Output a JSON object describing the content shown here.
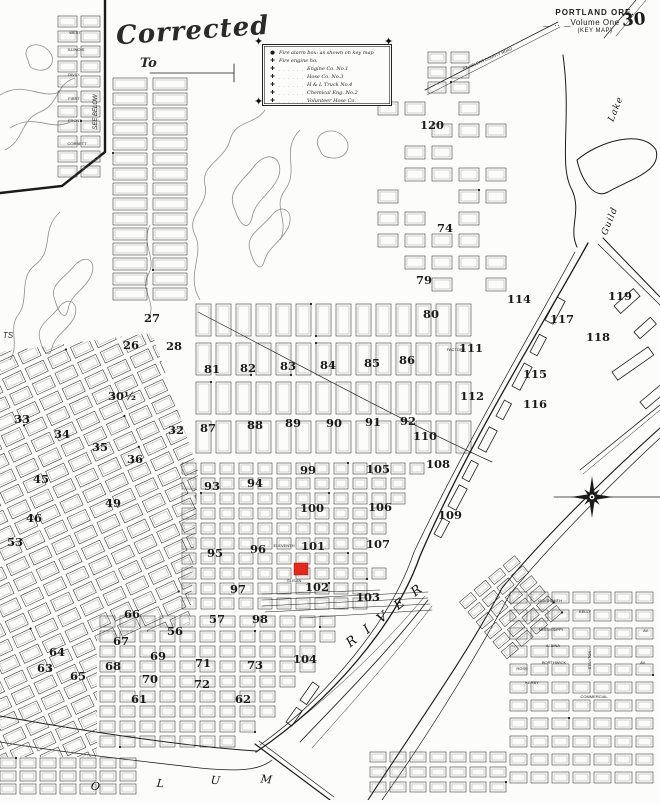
{
  "page": {
    "title": "PORTLAND ORE.",
    "subtitle": "Volume One",
    "map_type": "(KEY MAP)",
    "page_number": "30",
    "decor_dashes": "— ·· —",
    "corner_note": "also  shown"
  },
  "corrected": {
    "word": "Corrected",
    "to": "To"
  },
  "legend": {
    "alarm_symbol": "●",
    "engine_symbol": "✚",
    "corner_ornament": "✦",
    "alarm_line": "Fire alarm box: as shown on key map",
    "engine_line": "Fire engine ho.",
    "leader": ". . . . . .",
    "items": [
      "Engine Co. No.1",
      "Hose Co. No.3",
      "H & L Truck No.4",
      "Chemical Eng. No.2",
      "Volunteer Hose Co."
    ]
  },
  "colors": {
    "ink": "#1b1b1b",
    "contour": "#8f8f8f",
    "block": "#2e2e2e",
    "inner": "#9a9a9a",
    "marker": "#e5271d"
  },
  "marker": {
    "x": 294,
    "y": 563,
    "w": 14,
    "h": 12
  },
  "compass": {
    "x": 592,
    "y": 497
  },
  "water_labels": [
    {
      "text": "R I V E R",
      "x": 388,
      "y": 618,
      "r": -38,
      "s": 13,
      "i": true,
      "sp": 4
    },
    {
      "text": "Guild",
      "x": 612,
      "y": 222,
      "r": -68,
      "s": 9,
      "i": true,
      "sp": 1
    },
    {
      "text": "Lake",
      "x": 618,
      "y": 110,
      "r": -68,
      "s": 9,
      "i": true,
      "sp": 1
    },
    {
      "text": "O",
      "x": 95,
      "y": 790,
      "r": 6,
      "s": 11,
      "i": true,
      "sp": 0
    },
    {
      "text": "L",
      "x": 160,
      "y": 787,
      "r": 6,
      "s": 11,
      "i": true,
      "sp": 0
    },
    {
      "text": "U",
      "x": 215,
      "y": 784,
      "r": 6,
      "s": 11,
      "i": true,
      "sp": 0
    },
    {
      "text": "M",
      "x": 266,
      "y": 783,
      "r": 6,
      "s": 11,
      "i": true,
      "sp": 0
    }
  ],
  "street_labels": [
    {
      "text": "WEST",
      "x": 75,
      "y": 34,
      "s": 4
    },
    {
      "text": "ILLINOIS",
      "x": 76,
      "y": 51,
      "s": 4
    },
    {
      "text": "DIVID.",
      "x": 74,
      "y": 76,
      "s": 4
    },
    {
      "text": "FIRST",
      "x": 74,
      "y": 100,
      "s": 4
    },
    {
      "text": "FRONT",
      "x": 75,
      "y": 122,
      "s": 4
    },
    {
      "text": "CORBETT",
      "x": 77,
      "y": 145,
      "s": 4
    },
    {
      "text": "SEE BELOW",
      "x": 97,
      "y": 112,
      "s": 6,
      "r": -90,
      "i": true
    },
    {
      "text": "ST. HELENS COUNTY ROAD",
      "x": 488,
      "y": 60,
      "s": 4,
      "r": -23
    },
    {
      "text": "ELEVENTH",
      "x": 284,
      "y": 547,
      "s": 4
    },
    {
      "text": "GLISAN",
      "x": 294,
      "y": 582,
      "s": 4
    },
    {
      "text": "FACTORY",
      "x": 456,
      "y": 351,
      "s": 4
    },
    {
      "text": "GOLDSMITH",
      "x": 550,
      "y": 602,
      "s": 4
    },
    {
      "text": "KELLY",
      "x": 585,
      "y": 613,
      "s": 4
    },
    {
      "text": "MISSISSIPPI",
      "x": 551,
      "y": 631,
      "s": 4
    },
    {
      "text": "ALBINA",
      "x": 553,
      "y": 647,
      "s": 4
    },
    {
      "text": "BORTHWICK",
      "x": 554,
      "y": 664,
      "s": 4
    },
    {
      "text": "ROSS",
      "x": 522,
      "y": 670,
      "s": 4
    },
    {
      "text": "KERBY",
      "x": 532,
      "y": 684,
      "s": 4
    },
    {
      "text": "COMMERCIAL",
      "x": 594,
      "y": 698,
      "s": 4
    },
    {
      "text": "STANTON",
      "x": 591,
      "y": 660,
      "s": 4,
      "r": -90
    },
    {
      "text": "AV.",
      "x": 646,
      "y": 632,
      "s": 4
    },
    {
      "text": "AV.",
      "x": 643,
      "y": 664,
      "s": 4
    },
    {
      "text": "TS",
      "x": 8,
      "y": 338,
      "s": 8,
      "i": true
    }
  ],
  "district_numbers": [
    {
      "n": "120",
      "x": 432,
      "y": 129
    },
    {
      "n": "74",
      "x": 445,
      "y": 232
    },
    {
      "n": "79",
      "x": 424,
      "y": 284
    },
    {
      "n": "80",
      "x": 431,
      "y": 318
    },
    {
      "n": "86",
      "x": 407,
      "y": 364
    },
    {
      "n": "114",
      "x": 519,
      "y": 303
    },
    {
      "n": "119",
      "x": 620,
      "y": 300
    },
    {
      "n": "117",
      "x": 562,
      "y": 323
    },
    {
      "n": "118",
      "x": 598,
      "y": 341
    },
    {
      "n": "111",
      "x": 471,
      "y": 352
    },
    {
      "n": "112",
      "x": 472,
      "y": 400
    },
    {
      "n": "115",
      "x": 535,
      "y": 378
    },
    {
      "n": "116",
      "x": 535,
      "y": 408
    },
    {
      "n": "81",
      "x": 212,
      "y": 373
    },
    {
      "n": "82",
      "x": 248,
      "y": 372
    },
    {
      "n": "83",
      "x": 288,
      "y": 370
    },
    {
      "n": "84",
      "x": 328,
      "y": 369
    },
    {
      "n": "85",
      "x": 372,
      "y": 367
    },
    {
      "n": "87",
      "x": 208,
      "y": 432
    },
    {
      "n": "88",
      "x": 255,
      "y": 429
    },
    {
      "n": "89",
      "x": 293,
      "y": 427
    },
    {
      "n": "90",
      "x": 334,
      "y": 427
    },
    {
      "n": "91",
      "x": 373,
      "y": 426
    },
    {
      "n": "92",
      "x": 408,
      "y": 425
    },
    {
      "n": "93",
      "x": 212,
      "y": 490
    },
    {
      "n": "94",
      "x": 255,
      "y": 487
    },
    {
      "n": "99",
      "x": 308,
      "y": 474
    },
    {
      "n": "105",
      "x": 378,
      "y": 473
    },
    {
      "n": "100",
      "x": 312,
      "y": 512
    },
    {
      "n": "106",
      "x": 380,
      "y": 511
    },
    {
      "n": "95",
      "x": 215,
      "y": 557
    },
    {
      "n": "96",
      "x": 258,
      "y": 553
    },
    {
      "n": "101",
      "x": 313,
      "y": 550
    },
    {
      "n": "107",
      "x": 378,
      "y": 548
    },
    {
      "n": "102",
      "x": 317,
      "y": 591
    },
    {
      "n": "103",
      "x": 368,
      "y": 601
    },
    {
      "n": "104",
      "x": 305,
      "y": 663
    },
    {
      "n": "108",
      "x": 438,
      "y": 468
    },
    {
      "n": "109",
      "x": 450,
      "y": 519
    },
    {
      "n": "110",
      "x": 425,
      "y": 440
    },
    {
      "n": "26",
      "x": 131,
      "y": 349
    },
    {
      "n": "27",
      "x": 152,
      "y": 322
    },
    {
      "n": "28",
      "x": 174,
      "y": 350
    },
    {
      "n": "30½",
      "x": 122,
      "y": 400
    },
    {
      "n": "32",
      "x": 176,
      "y": 434
    },
    {
      "n": "33",
      "x": 22,
      "y": 423
    },
    {
      "n": "34",
      "x": 62,
      "y": 438
    },
    {
      "n": "35",
      "x": 100,
      "y": 451
    },
    {
      "n": "36",
      "x": 135,
      "y": 463
    },
    {
      "n": "45",
      "x": 41,
      "y": 483
    },
    {
      "n": "46",
      "x": 34,
      "y": 522
    },
    {
      "n": "49",
      "x": 113,
      "y": 507
    },
    {
      "n": "53",
      "x": 15,
      "y": 546
    },
    {
      "n": "56",
      "x": 175,
      "y": 635
    },
    {
      "n": "57",
      "x": 217,
      "y": 623
    },
    {
      "n": "98",
      "x": 260,
      "y": 623
    },
    {
      "n": "97",
      "x": 238,
      "y": 593
    },
    {
      "n": "66",
      "x": 132,
      "y": 618
    },
    {
      "n": "67",
      "x": 121,
      "y": 645
    },
    {
      "n": "68",
      "x": 113,
      "y": 670
    },
    {
      "n": "69",
      "x": 158,
      "y": 660
    },
    {
      "n": "70",
      "x": 150,
      "y": 683
    },
    {
      "n": "71",
      "x": 203,
      "y": 667
    },
    {
      "n": "72",
      "x": 202,
      "y": 688
    },
    {
      "n": "73",
      "x": 255,
      "y": 669
    },
    {
      "n": "61",
      "x": 139,
      "y": 703
    },
    {
      "n": "62",
      "x": 243,
      "y": 703
    },
    {
      "n": "63",
      "x": 45,
      "y": 672
    },
    {
      "n": "64",
      "x": 57,
      "y": 656
    },
    {
      "n": "65",
      "x": 78,
      "y": 680
    }
  ],
  "regions": [
    {
      "name": "left-strips",
      "x0": 113,
      "y0": 78,
      "cols": 2,
      "rows": 15,
      "bw": 34,
      "bh": 12,
      "sx": 40,
      "sy": 15
    },
    {
      "name": "inset-grid",
      "x0": 58,
      "y0": 16,
      "cols": 2,
      "rows": 11,
      "bw": 19,
      "bh": 11,
      "sx": 23,
      "sy": 15
    },
    {
      "name": "north-sparse",
      "x0": 378,
      "y0": 102,
      "cols": 5,
      "rows": 9,
      "bw": 20,
      "bh": 13,
      "sx": 27,
      "sy": 22,
      "skip": 0.38
    },
    {
      "name": "north-cluster",
      "x0": 428,
      "y0": 52,
      "cols": 2,
      "rows": 3,
      "bw": 18,
      "bh": 11,
      "sx": 23,
      "sy": 15
    },
    {
      "name": "nw-tall-grid",
      "x0": 196,
      "y0": 304,
      "cols": 14,
      "rows": 4,
      "bw": 15,
      "bh": 32,
      "sx": 20,
      "sy": 39
    },
    {
      "name": "downtown-grid",
      "x0": 182,
      "y0": 463,
      "cols": 15,
      "rows": 10,
      "bw": 14,
      "bh": 11,
      "sx": 19,
      "sy": 15,
      "riverclip": true
    },
    {
      "name": "south-central-grid",
      "x0": 100,
      "y0": 616,
      "cols": 17,
      "rows": 9,
      "bw": 15,
      "bh": 11,
      "sx": 20,
      "sy": 15,
      "riverclip": true
    },
    {
      "name": "sw-rotated-grid",
      "tx": -60,
      "ty": 470,
      "rot": -25,
      "x0": -80,
      "y0": -90,
      "cols": 19,
      "rows": 25,
      "bw": 20,
      "bh": 12,
      "sx": 25,
      "sy": 17,
      "clip": "swclip"
    },
    {
      "name": "albina-grid",
      "x0": 510,
      "y0": 592,
      "cols": 7,
      "rows": 11,
      "bw": 17,
      "bh": 11,
      "sx": 21,
      "sy": 18
    },
    {
      "name": "albina-rotated",
      "tx": 498,
      "ty": 648,
      "rot": -40,
      "x0": 0,
      "y0": -60,
      "cols": 4,
      "rows": 6,
      "bw": 15,
      "bh": 9,
      "sx": 19,
      "sy": 13
    },
    {
      "name": "bottom-left-strip",
      "x0": 0,
      "y0": 758,
      "cols": 7,
      "rows": 3,
      "bw": 16,
      "bh": 10,
      "sx": 20,
      "sy": 13
    },
    {
      "name": "bottom-mid-strip",
      "x0": 370,
      "y0": 752,
      "cols": 7,
      "rows": 3,
      "bw": 16,
      "bh": 10,
      "sx": 20,
      "sy": 15
    }
  ],
  "contours": [
    "M200,300 C185,275 205,255 195,235 C185,215 210,205 205,185 C200,165 225,160 230,140 C235,120 255,125 265,110",
    "M235,210 C225,190 245,180 255,165 C270,148 285,160 278,178 C270,195 255,200 252,218 C248,232 240,225 235,210 Z",
    "M250,250 C245,235 262,228 272,215 C283,202 295,212 288,228 C280,243 268,247 264,262 C260,274 253,262 250,250 Z",
    "M300,130 C280,150 300,170 285,190 C272,207 290,220 280,240",
    "M320,150 C310,135 330,125 342,135 C355,146 345,160 332,158 C325,157 322,156 320,150 Z",
    "M60,212 C40,230 55,250 35,265 C18,278 30,300 18,315 C8,328 20,345 10,360",
    "M55,300 C48,285 65,278 75,265 C88,252 98,263 90,278 C82,292 70,295 68,310 C65,322 58,312 55,300 Z",
    "M40,340 C35,325 52,318 60,306 C70,295 80,305 74,318 C66,332 55,335 52,348 C49,360 43,352 40,340 Z",
    "M150,225 C140,245 158,258 148,275 C140,290 155,300 150,315",
    "M0,95 C25,80 40,100 60,92",
    "M10,128 C35,112 50,132 70,122",
    "M28,60 C20,45 38,40 48,50 C58,60 50,72 38,70 C30,68 30,68 28,60 Z",
    "M5,150 C25,140 20,120 40,112 C60,104 55,84 75,78"
  ],
  "lines": [
    {
      "d": "M105,0 L105,152 L62,186 L0,193",
      "w": 2.4
    },
    {
      "d": "M588,243 C540,330 470,440 420,556 C396,625 330,702 256,752",
      "w": 1.3
    },
    {
      "d": "M575,252 C530,335 465,445 414,552 C392,618 330,695 260,745",
      "w": 0.7
    },
    {
      "d": "M660,428 C600,482 540,542 502,588 C470,650 420,720 368,800",
      "w": 1.1
    },
    {
      "d": "M660,438 C604,490 548,548 510,594 C482,646 436,724 382,800",
      "w": 0.7
    },
    {
      "d": "M603,238 L660,297",
      "w": 1.0
    },
    {
      "d": "M598,244 L660,305",
      "w": 0.7
    },
    {
      "d": "M563,55 C572,120 558,165 572,190 C582,212 568,228 577,247",
      "w": 1.0
    },
    {
      "d": "M577,160 C598,142 642,128 656,150 C662,172 628,180 608,192 C593,200 581,178 577,160 Z",
      "w": 1.0
    },
    {
      "d": "M425,90 L558,22",
      "w": 0.8
    },
    {
      "d": "M427,95 L560,27",
      "w": 0.5
    },
    {
      "d": "M554,497 L660,497",
      "w": 0.8
    },
    {
      "d": "M580,470 L660,405",
      "w": 0.8
    },
    {
      "d": "M583,474 L660,410",
      "w": 0.5
    },
    {
      "d": "M255,744 L330,800",
      "w": 1.2
    },
    {
      "d": "M259,741 L334,797",
      "w": 0.7
    },
    {
      "d": "M0,716 C90,732 180,746 256,751",
      "w": 1.0
    },
    {
      "d": "M0,742 C60,752 130,760 200,768 C240,772 260,770 272,760",
      "w": 0.8
    },
    {
      "d": "M198,312 C300,365 400,420 492,462",
      "w": 0.7
    },
    {
      "d": "M262,600 L428,592",
      "w": 0.5
    },
    {
      "d": "M262,606 L428,598",
      "w": 0.5
    },
    {
      "d": "M265,612 L430,604",
      "w": 0.5
    },
    {
      "d": "M300,618 L432,610",
      "w": 0.5
    },
    {
      "d": "M262,594 L380,590",
      "w": 0.5
    },
    {
      "d": "M428,600 C390,650 340,700 300,742",
      "w": 0.8
    },
    {
      "d": "M432,606 C395,655 350,705 312,748",
      "w": 0.5
    },
    {
      "d": "M425,596 C380,650 330,696 280,735",
      "w": 0.5
    },
    {
      "d": "M636,0 L604,38",
      "w": 0.7
    },
    {
      "d": "M646,0 L616,36",
      "w": 0.5
    },
    {
      "d": "M150,73 L234,73 M234,64 L234,82",
      "w": 0.8
    }
  ],
  "wharves": [
    {
      "x": 545,
      "y": 320,
      "w": 26,
      "h": 9,
      "r": -62
    },
    {
      "x": 530,
      "y": 352,
      "w": 20,
      "h": 8,
      "r": -62
    },
    {
      "x": 512,
      "y": 386,
      "w": 26,
      "h": 9,
      "r": -62
    },
    {
      "x": 496,
      "y": 416,
      "w": 18,
      "h": 8,
      "r": -62
    },
    {
      "x": 478,
      "y": 448,
      "w": 24,
      "h": 9,
      "r": -62
    },
    {
      "x": 462,
      "y": 478,
      "w": 20,
      "h": 8,
      "r": -62
    },
    {
      "x": 448,
      "y": 506,
      "w": 24,
      "h": 9,
      "r": -62
    },
    {
      "x": 434,
      "y": 534,
      "w": 18,
      "h": 8,
      "r": -62
    },
    {
      "x": 614,
      "y": 306,
      "w": 26,
      "h": 10,
      "r": -42
    },
    {
      "x": 634,
      "y": 332,
      "w": 22,
      "h": 9,
      "r": -42
    },
    {
      "x": 612,
      "y": 372,
      "w": 44,
      "h": 10,
      "r": -35
    },
    {
      "x": 640,
      "y": 402,
      "w": 30,
      "h": 9,
      "r": -40
    },
    {
      "x": 300,
      "y": 700,
      "w": 22,
      "h": 8,
      "r": -55
    },
    {
      "x": 286,
      "y": 722,
      "w": 18,
      "h": 7,
      "r": -55
    }
  ]
}
